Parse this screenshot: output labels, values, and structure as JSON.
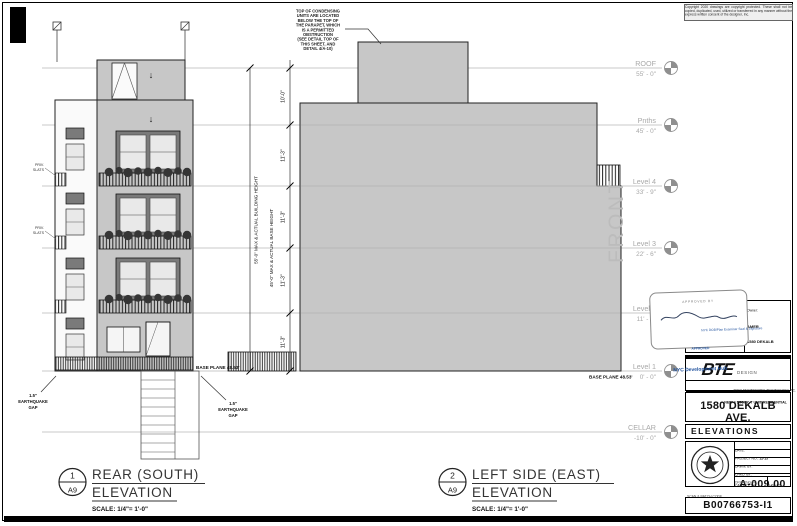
{
  "sheet": {
    "copyright": "Copyright 2020 drawings are copyright protected. These shall not be copied, duplicated, used, utilized or transferred in any manner without the express written consent of the designer, Inc.",
    "scan_code": "B00766753-I1"
  },
  "levels": [
    {
      "name": "ROOF",
      "elev": "55' - 0\""
    },
    {
      "name": "Pnths",
      "elev": "45' - 0\""
    },
    {
      "name": "Level 4",
      "elev": "33' - 9\""
    },
    {
      "name": "Level 3",
      "elev": "22' - 6\""
    },
    {
      "name": "Level 2",
      "elev": "11' - 3\""
    },
    {
      "name": "Level 1",
      "elev": "0' - 0\""
    },
    {
      "name": "CELLAR",
      "elev": "-10' - 0\""
    }
  ],
  "dimensions": {
    "building_height": "55'-0\" MAX & ACTUAL BUILDING HEIGHT",
    "base_height": "45'-0\" MAX & ACTUAL BASE HEIGHT",
    "segments": [
      "10'-0\"",
      "11'-3\"",
      "11'-3\"",
      "11'-3\"",
      "11'-3\""
    ]
  },
  "annotations": {
    "front": "FRONT",
    "base_plane_left": "BASE PLANE  48.53'",
    "base_plane_right": "BASE PLANE  48.53'",
    "eq_left": [
      "1.5\"",
      "EARTHQUAKE",
      "GAP"
    ],
    "eq_right": [
      "1.5\"",
      "EARTHQUAKE",
      "GAP"
    ],
    "priv_top": [
      "PRIV.",
      "SLATS"
    ],
    "priv_bottom": [
      "PRIV.",
      "SLATS"
    ],
    "top_note": [
      "TOP OF CONDENSING",
      "UNITS ARE LOCATED",
      "BELOW THE TOP OF",
      "THE PARAPET, WHICH",
      "IS A PERMITTED",
      "OBSTRUCTION",
      "(SEE DETAIL TOP OF",
      "THIS SHEET, AND",
      "DETAIL 4/A-10)"
    ]
  },
  "views": [
    {
      "num": "1",
      "sheet_ref": "A9",
      "title1": "REAR (SOUTH)",
      "title2": "ELEVATION",
      "scale": "SCALE:  1/4\"=  1'-0\""
    },
    {
      "num": "2",
      "sheet_ref": "A9",
      "title1": "LEFT SIDE (EAST)",
      "title2": "ELEVATION",
      "scale": "SCALE:  1/4\"=  1'-0\""
    }
  ],
  "stamp": {
    "approved_by": "APPROVED BY",
    "line1": "NYC DOB/Plan Examiner Seal & Signature",
    "line2": "APPROVED",
    "hub": "NYC Development Hub"
  },
  "title_block": {
    "owner_label": "Owner:",
    "owner_line1": "AMER",
    "owner_line2": "1580 DEKALB",
    "owner_line3": "LLC",
    "firm_logo": "BTE",
    "firm_logo_sub": "DESIGN",
    "firm_line1": "ARCH ENGINEERING TECHNOLOGY, P.C.",
    "firm_line2": "BROOKLYN, NEW YORK",
    "project_type": "NEW 4 STORY, 7 UNIT RESIDENTIAL",
    "project_address": "1580 DEKALB AVE.",
    "project_city": "BROOKLYN,  NEW YORK",
    "sheet_title": "ELEVATIONS",
    "date_label": "DATE:",
    "project_no_label": "PROJECT NO.:",
    "project_no": "12-15",
    "drawn_label": "DRWN. BY:",
    "checked_label": "CHKD. BY:",
    "drawing_no_label": "DRAWING No.",
    "drawing_no": "A-009.00",
    "cad_label": "CAD FILE No.",
    "page": "9 OF 12",
    "batch_label": "SCAN & BATCH CODE"
  }
}
